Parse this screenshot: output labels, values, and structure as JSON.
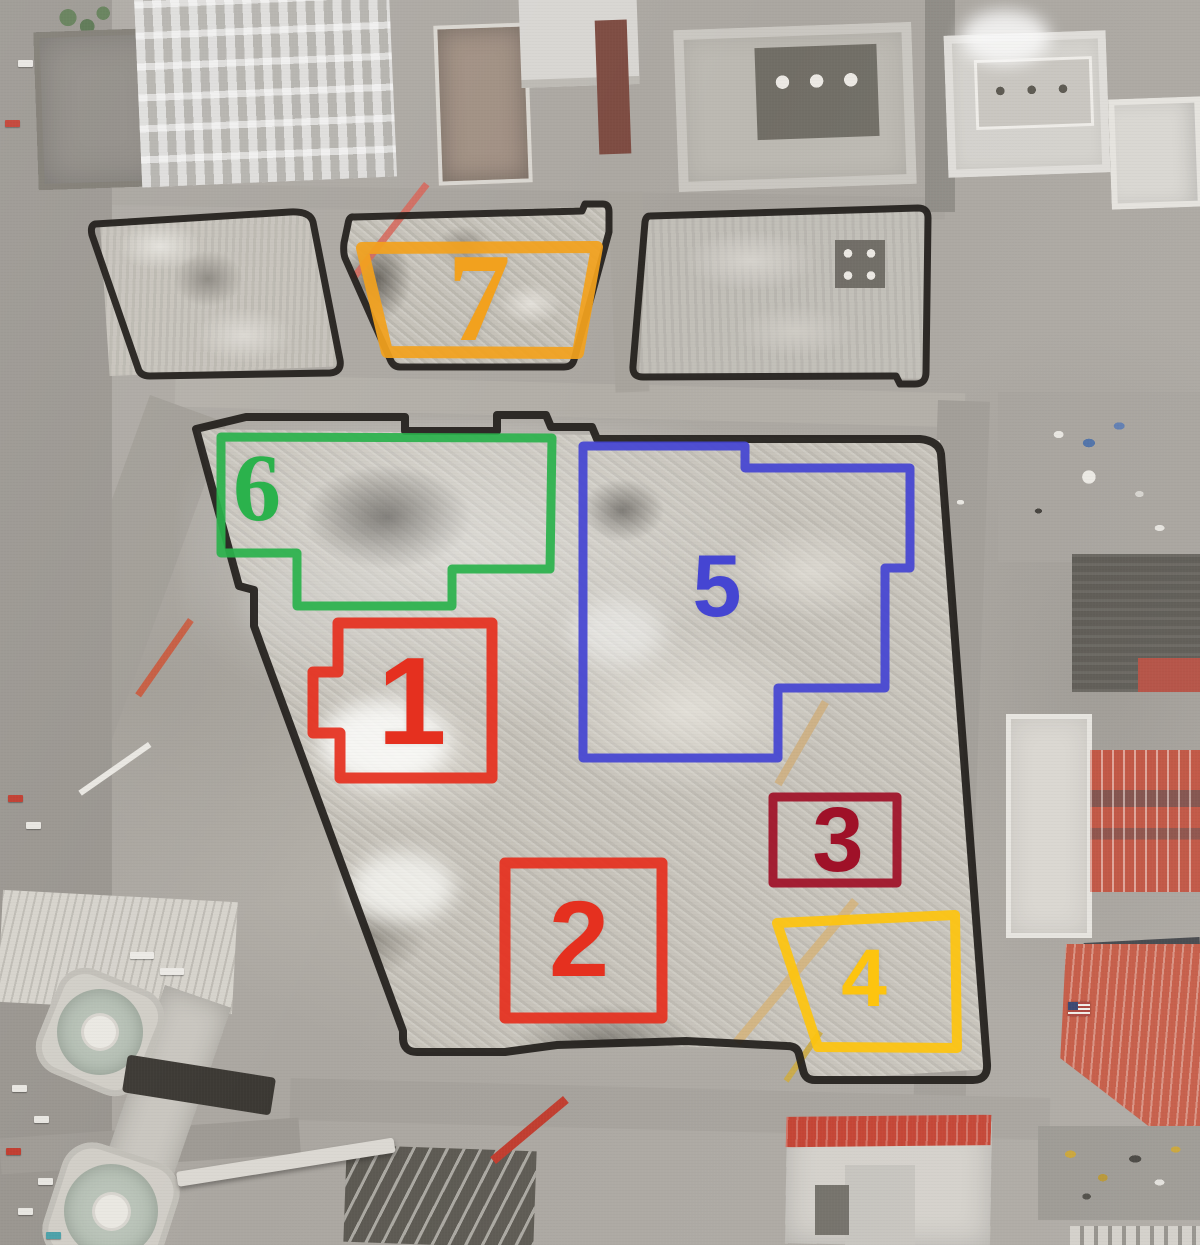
{
  "meta": {
    "title": "Aerial photograph of the World Trade Center site (Ground Zero) with numbered building footprint outlines",
    "width": 1200,
    "height": 1245
  },
  "colors": {
    "outline_black": "#221e1b",
    "red": "#e5301f",
    "dark_red": "#9f1128",
    "orange": "#f2a11e",
    "yellow": "#fdc40f",
    "green": "#2bb24c",
    "blue": "#4545d2"
  },
  "zones": [
    {
      "id": "wtc-1",
      "label": "1",
      "color": "#e5301f",
      "font": "sans",
      "font_size": 124,
      "stroke_width": 11,
      "label_x": 412,
      "label_y": 702,
      "points": [
        [
          338,
          623
        ],
        [
          492,
          623
        ],
        [
          492,
          778
        ],
        [
          340,
          778
        ],
        [
          340,
          733
        ],
        [
          313,
          733
        ],
        [
          313,
          672
        ],
        [
          338,
          672
        ]
      ]
    },
    {
      "id": "wtc-2",
      "label": "2",
      "color": "#e5301f",
      "font": "sans",
      "font_size": 108,
      "stroke_width": 11,
      "label_x": 579,
      "label_y": 939,
      "points": [
        [
          505,
          863
        ],
        [
          662,
          863
        ],
        [
          662,
          1018
        ],
        [
          505,
          1018
        ]
      ]
    },
    {
      "id": "wtc-3",
      "label": "3",
      "color": "#9f1128",
      "font": "sans",
      "font_size": 92,
      "stroke_width": 9,
      "label_x": 838,
      "label_y": 840,
      "points": [
        [
          773,
          797
        ],
        [
          897,
          797
        ],
        [
          897,
          883
        ],
        [
          773,
          883
        ]
      ]
    },
    {
      "id": "wtc-4",
      "label": "4",
      "color": "#fdc40f",
      "font": "sans",
      "font_size": 82,
      "stroke_width": 10,
      "label_x": 864,
      "label_y": 979,
      "points": [
        [
          777,
          923
        ],
        [
          955,
          915
        ],
        [
          957,
          1048
        ],
        [
          818,
          1047
        ]
      ]
    },
    {
      "id": "wtc-5",
      "label": "5",
      "color": "#4545d2",
      "font": "sans",
      "font_size": 88,
      "stroke_width": 9,
      "label_x": 717,
      "label_y": 586,
      "points": [
        [
          583,
          446
        ],
        [
          745,
          446
        ],
        [
          745,
          468
        ],
        [
          910,
          468
        ],
        [
          910,
          568
        ],
        [
          885,
          568
        ],
        [
          885,
          688
        ],
        [
          778,
          688
        ],
        [
          778,
          758
        ],
        [
          583,
          758
        ]
      ]
    },
    {
      "id": "wtc-6",
      "label": "6",
      "color": "#2bb24c",
      "font": "serif",
      "font_size": 96,
      "stroke_width": 9,
      "label_x": 257,
      "label_y": 488,
      "points": [
        [
          221,
          437
        ],
        [
          552,
          438
        ],
        [
          550,
          569
        ],
        [
          452,
          569
        ],
        [
          452,
          606
        ],
        [
          297,
          606
        ],
        [
          297,
          553
        ],
        [
          221,
          553
        ]
      ]
    },
    {
      "id": "wtc-7",
      "label": "7",
      "color": "#f2a11e",
      "font": "serif",
      "font_size": 126,
      "stroke_width": 12,
      "label_x": 479,
      "label_y": 299,
      "points": [
        [
          362,
          248
        ],
        [
          597,
          247
        ],
        [
          578,
          353
        ],
        [
          387,
          352
        ]
      ]
    }
  ],
  "site_outlines": [
    {
      "id": "main-site-boundary",
      "width": 8,
      "path": "M 196,429 L 246,417 L 405,417 L 405,431 L 497,431 L 497,415 L 546,415 L 551,427 L 592,427 L 597,439 L 920,439 Q 939,441 941,454 L 987,1064 Q 988,1080 973,1080 L 815,1080 Q 805,1080 803,1070 L 799,1054 Q 797,1046 787,1046 L 686,1041 L 557,1045 L 505,1052 L 417,1052 Q 404,1052 403,1039 L 403,1031 L 263,651 L 254,626 L 254,590 L 239,586 Z"
    },
    {
      "id": "verizon-block",
      "width": 7,
      "path": "M 95,224 L 290,212 Q 310,211 313,222 L 340,360 Q 342,372 330,373 L 150,376 Q 140,376 138,368 L 92,235 Q 90,226 95,224 Z"
    },
    {
      "id": "post-office-block",
      "width": 7,
      "path": "M 650,216 L 918,208 Q 928,208 928,218 L 926,372 Q 926,384 915,384 L 900,384 L 896,376 L 643,377 Q 632,377 633,366 L 645,222 Q 646,216 650,216 Z"
    },
    {
      "id": "wtc7-block",
      "width": 7,
      "path": "M 354,217 L 582,211 L 585,204 L 603,204 Q 609,204 609,212 L 609,232 L 574,360 Q 572,367 564,367 L 400,367 Q 393,367 390,359 L 345,258 Q 343,252 344,243 L 348,224 Q 349,216 354,217 Z"
    }
  ]
}
